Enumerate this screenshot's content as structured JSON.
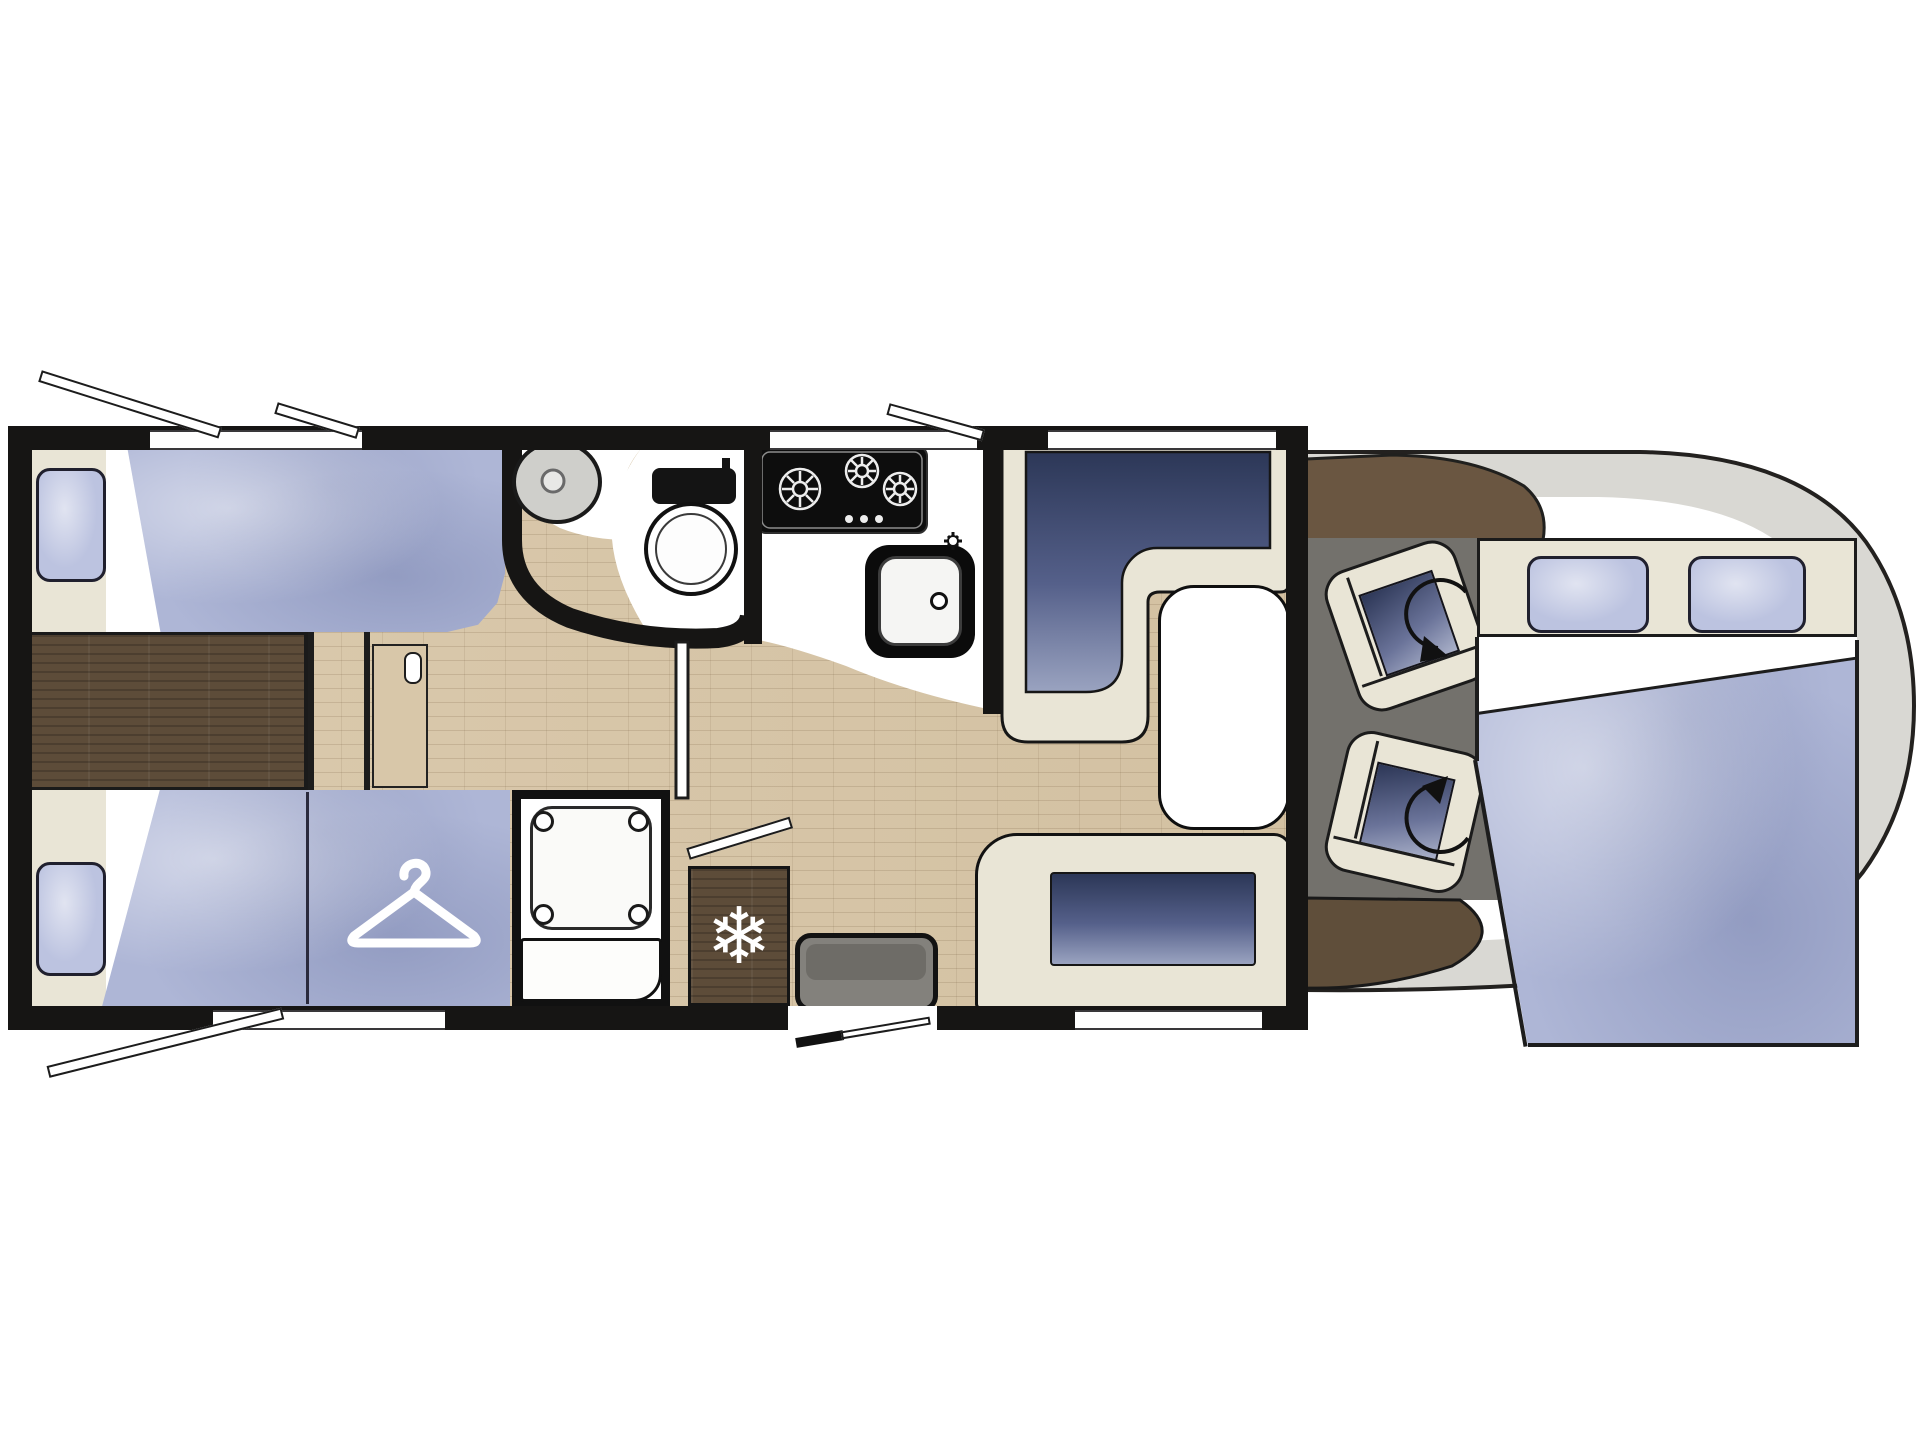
{
  "title": "motorhome-floorplan",
  "icons": {
    "snowflake_glyph": "❄",
    "hanger": "clothes-hanger",
    "rotation_arrows": "swivel-seat-rotation",
    "burner_count": 3
  },
  "colors": {
    "wall": "#161514",
    "cream_trim": "#e9e5d6",
    "mattress_blue": "#aeb6d6",
    "cushion_navy": "#2c3757",
    "floor_wood_light": "#d8c7a9",
    "wood_dark": "#5d4c39",
    "cab_body_gray": "#d9d8d3",
    "cab_floor_gray": "#73716c",
    "appliance_black": "#0d0d0d",
    "background": "#ffffff"
  },
  "rooms": {
    "rear_bedroom": {
      "fixtures": [
        "twin-bed-top",
        "twin-bed-bottom",
        "wardrobe",
        "center-walkway",
        "sliding-door",
        "pillows",
        "side-windows"
      ]
    },
    "washroom": {
      "fixtures": [
        "round-basin",
        "toilet",
        "curved-partition",
        "washroom-door"
      ]
    },
    "shower_room": {
      "fixtures": [
        "shower-tray"
      ]
    },
    "kitchen": {
      "fixtures": [
        "three-burner-hob",
        "kitchen-sink",
        "tap",
        "refrigerator",
        "worktop"
      ]
    },
    "lounge": {
      "fixtures": [
        "l-shaped-dinette",
        "pedestal-table",
        "side-bench",
        "entry-door",
        "entry-step"
      ]
    },
    "cab": {
      "fixtures": [
        "dashboard",
        "driver-swivel-seat",
        "passenger-swivel-seat",
        "drop-down-bed",
        "bed-pillows"
      ]
    }
  }
}
